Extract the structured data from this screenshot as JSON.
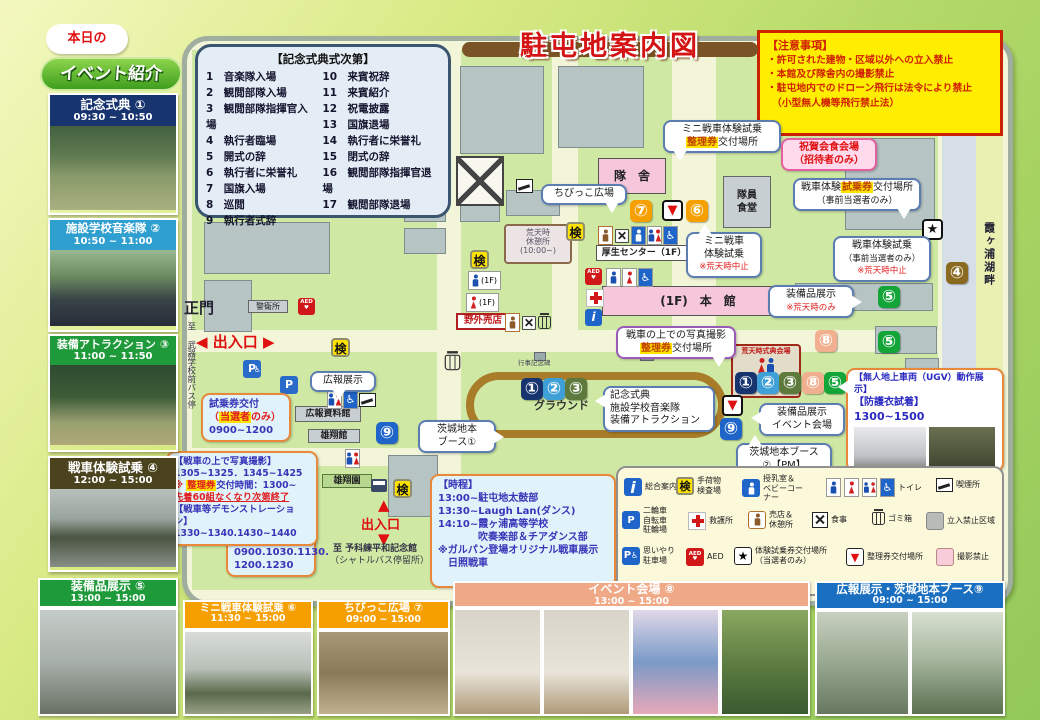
{
  "title": "駐屯地案内図",
  "colors": {
    "title_red": "#d41414",
    "notice_bg": "#ffee00",
    "notice_red": "#d02000",
    "highlight": "#ffe300",
    "badge_orange": "#f5a000",
    "badge_green": "#13a538",
    "badge_navy": "#17346f",
    "badge_lightblue": "#3fa0d8",
    "badge_olive": "#5d7a3c",
    "badge_brown": "#8a6a1f",
    "badge_blue": "#1f64c8",
    "badge_salmon": "#f0b090",
    "header_orange": "#f59f00",
    "header_salmon": "#efa986",
    "header_blue": "#1a6fc0",
    "header_green": "#1f9a3a",
    "header_navy": "#17346f",
    "header_lightblue": "#2f9fd0",
    "header_khaki": "#4a431d"
  },
  "sidebar": {
    "bubble": "本日の",
    "heading": "イベント紹介",
    "events": [
      {
        "label": "記念式典 ①",
        "time": "09:30 ~ 10:50"
      },
      {
        "label": "施設学校音楽隊 ②",
        "time": "10:50 ~ 11:00"
      },
      {
        "label": "装備アトラクション ③",
        "time": "11:00 ~ 11:50"
      },
      {
        "label": "戦車体験試乗 ④",
        "time": "12:00 ~ 15:00"
      }
    ]
  },
  "ceremony": {
    "title": "【記念式典式次第】",
    "left": "1　音楽隊入場\n2　観閲部隊入場\n3　観閲部隊指揮官入場\n4　執行者臨場\n5　開式の辞\n6　執行者に栄誉礼\n7　国旗入場\n8　巡閲\n9　執行者式辞",
    "right": "10　来賓祝辞\n11　来賓紹介\n12　祝電披露\n13　国旗退場\n14　執行者に栄誉礼\n15　閉式の辞\n16　観閲部隊指揮官退場\n17　観閲部隊退場"
  },
  "notice": {
    "title": "【注意事項】",
    "lines": "・許可された建物・区域以外への立入禁止\n・本館及び隊舎内の撮影禁止\n・駐屯地内でのドローン飛行は法令により禁止\n　（小型無人機等飛行禁止法）"
  },
  "map": {
    "gate": "正門",
    "exit1": "出入口",
    "exit2": "出入口",
    "bus_left": "至 武器学校前バス停",
    "lakeside": "霞ヶ浦湖畔",
    "shuttle1": "至 予科練平和記念館",
    "shuttle2": "（シャトルバス停留所）",
    "compass": "N",
    "ground": "グラウンド",
    "monument": "行事記念碑",
    "buildings": {
      "taisha": "隊　舎",
      "dining": "隊員\n食堂",
      "kosei": "厚生センター（1F）",
      "honkan": "(1F)　本　館",
      "rest": "荒天時\n休憩所\n(10:00~)",
      "yagai": "野外売店",
      "keiei": "警衛所",
      "koho": "広報資料館",
      "yushokan": "雄翔館",
      "yushoen": "雄翔園",
      "storm": "荒天時式典会場",
      "toilet_m_1f": "(1F)",
      "toilet_w_1f": "(1F)"
    },
    "callouts": {
      "chibikko": "ちびっこ広場",
      "mini_ticket": {
        "l1": "ミニ戦車体験試乗",
        "hl": "整理券",
        "l2": "交付場所"
      },
      "shukuga": {
        "l1": "祝賀会食会場",
        "l2": "（招待者のみ）"
      },
      "tank_ticket": {
        "a": "戦車体験",
        "hl": "試乗券",
        "b": "交付場所",
        "l2": "（事前当選者のみ）"
      },
      "mini_exp": {
        "l1": "ミニ戦車",
        "l2": "体験試乗",
        "l3": "※荒天時中止"
      },
      "tank_exp": {
        "l1": "戦車体験試乗",
        "l2": "（事前当選者のみ）",
        "l3": "※荒天時中止"
      },
      "equip_storm": {
        "l1": "装備品展示",
        "l2": "※荒天時のみ"
      },
      "photo_ticket": {
        "l1": "戦車の上での写真撮影",
        "hl": "整理券",
        "l2": "交付場所"
      },
      "ground_events": {
        "l1": "記念式典",
        "l2": "施設学校音楽隊",
        "l3": "装備アトラクション"
      },
      "ibaraki1": {
        "l1": "茨城地本",
        "l2": "ブース①"
      },
      "ibaraki2": {
        "l1": "茨城地本ブース",
        "l2": "②【PM】"
      },
      "equip_venue": {
        "l1": "装備品展示",
        "l2": "イベント会場"
      },
      "koho_ex": "広報展示",
      "ticket_grant": {
        "l1": "試乗券交付",
        "p1": "（",
        "hl": "当選者",
        "p2": "のみ）",
        "l3": "0900~1200"
      },
      "seiriken": {
        "hl": "整理券",
        "a": "交付",
        "l2": "0900.1030.1130.",
        "l3": "1200.1230"
      },
      "ugv": {
        "l1": "【無人地上車両（UGV）動作展示】",
        "l2": "【防護衣試着】",
        "l3": "1300~1500"
      }
    },
    "tank_photo_box": {
      "l1": "【戦車の上で写真撮影】",
      "l2": "1305~1325．1345~1425",
      "l3pre": "※ ",
      "l3hl": "整理券",
      "l3post": "交付時間：1300~",
      "l4": "先着60組なくなり次第終了",
      "l5": "【戦車等デモンストレーション】",
      "l6": "1330~1340.1430~1440"
    },
    "schedule": {
      "title": "【時程】",
      "l1": "13:00~駐屯地太鼓部",
      "l2": "13:30~Laugh Lan(ダンス)",
      "l3": "14:10~霞ヶ浦高等学校",
      "l4": "　　　　吹奏楽部＆チアダンス部",
      "l5": "※ガルパン登場オリジナル戦車展示",
      "l6": "　日照戦車"
    }
  },
  "legend": {
    "items": [
      {
        "label": "総合案内"
      },
      {
        "label": "手荷物\n検査場"
      },
      {
        "label": "授乳室＆\nベビーコー\nナー"
      },
      {
        "label": "トイレ"
      },
      {
        "label": "喫煙所"
      },
      {
        "label": "二輪車\n自転車\n駐輪場"
      },
      {
        "label": "救護所"
      },
      {
        "label": "売店＆\n休憩所"
      },
      {
        "label": "食事"
      },
      {
        "label": "ゴミ箱"
      },
      {
        "label": "立入禁止区域"
      },
      {
        "label": "思いやり\n駐車場"
      },
      {
        "label": "AED"
      },
      {
        "label": "体験試乗券交付場所\n（当選者のみ）"
      },
      {
        "label": "整理券交付場所"
      },
      {
        "label": "撮影禁止"
      }
    ]
  },
  "bottom": {
    "sections": [
      {
        "label": "装備品展示 ⑤",
        "time": "13:00 ~ 15:00"
      },
      {
        "label": "ミニ戦車体験試乗 ⑥",
        "time": "11:30 ~ 15:00"
      },
      {
        "label": "ちびっこ広場 ⑦",
        "time": "09:00 ~ 15:00"
      },
      {
        "label": "イベント会場 ⑧",
        "time": "13:00 ~ 15:00"
      },
      {
        "label": "広報展示・茨城地本ブース⑨",
        "time": "09:00 ~ 15:00"
      }
    ]
  },
  "glyphs": {
    "star": "★",
    "tri": "▼",
    "kensa": "検",
    "info": "i",
    "p": "P",
    "aed": "AED",
    "heart": "♥",
    "wheel": "♿",
    "n1": "①",
    "n2": "②",
    "n3": "③",
    "n4": "④",
    "n5": "⑤",
    "n6": "⑥",
    "n7": "⑦",
    "n8": "⑧",
    "n9": "⑨",
    "left": "◀",
    "right": "▶",
    "up": "▲",
    "down": "▼"
  }
}
